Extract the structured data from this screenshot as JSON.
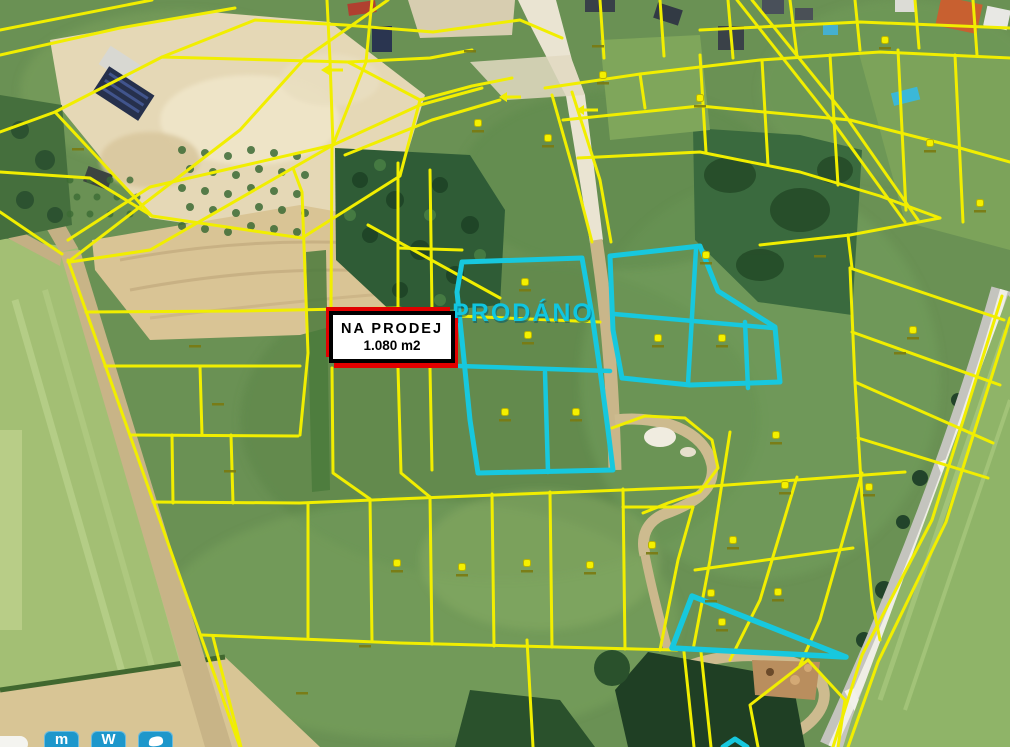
{
  "map": {
    "kind": "aerial-cadastral-map",
    "colors": {
      "cadastral_line": "#f1ee00",
      "highlight_parcel": "#17c8de",
      "marker_dot": "#f4f000",
      "marker_label": "#7a7a10",
      "railway": "#c4c4be",
      "watermark_button": "#1d97cb",
      "sale_accent": "#e10000"
    },
    "sale_label": {
      "line1": "NA   PRODEJ",
      "line2": "1.080 m2"
    },
    "sold_label": {
      "text": "PRODÁNO"
    },
    "cadastral_lines": [
      [
        [
          0,
          30
        ],
        [
          152,
          0
        ]
      ],
      [
        [
          0,
          55
        ],
        [
          120,
          28
        ],
        [
          235,
          8
        ]
      ],
      [
        [
          55,
          112
        ],
        [
          162,
          57
        ],
        [
          348,
          62
        ],
        [
          420,
          100
        ],
        [
          400,
          176
        ],
        [
          302,
          238
        ],
        [
          152,
          216
        ],
        [
          55,
          112
        ]
      ],
      [
        [
          162,
          57
        ],
        [
          255,
          20
        ],
        [
          345,
          25
        ],
        [
          433,
          32
        ],
        [
          520,
          20
        ],
        [
          562,
          38
        ]
      ],
      [
        [
          348,
          62
        ],
        [
          430,
          58
        ],
        [
          472,
          50
        ]
      ],
      [
        [
          420,
          100
        ],
        [
          472,
          86
        ],
        [
          512,
          78
        ]
      ],
      [
        [
          0,
          132
        ],
        [
          55,
          112
        ]
      ],
      [
        [
          0,
          172
        ],
        [
          90,
          178
        ],
        [
          152,
          216
        ]
      ],
      [
        [
          0,
          212
        ],
        [
          62,
          254
        ]
      ],
      [
        [
          68,
          260
        ],
        [
          240,
          747
        ]
      ],
      [
        [
          68,
          262
        ],
        [
          240,
          130
        ],
        [
          305,
          58
        ],
        [
          388,
          0
        ]
      ],
      [
        [
          333,
          145
        ],
        [
          150,
          187
        ],
        [
          68,
          240
        ]
      ],
      [
        [
          333,
          145
        ],
        [
          150,
          250
        ],
        [
          70,
          262
        ]
      ],
      [
        [
          86,
          312
        ],
        [
          240,
          311
        ],
        [
          398,
          308
        ],
        [
          458,
          316
        ],
        [
          600,
          322
        ]
      ],
      [
        [
          105,
          366
        ],
        [
          300,
          366
        ]
      ],
      [
        [
          130,
          435
        ],
        [
          298,
          436
        ]
      ],
      [
        [
          153,
          502
        ],
        [
          300,
          503
        ],
        [
          470,
          496
        ],
        [
          700,
          487
        ],
        [
          905,
          472
        ]
      ],
      [
        [
          202,
          635
        ],
        [
          400,
          643
        ],
        [
          677,
          650
        ]
      ],
      [
        [
          200,
          366
        ],
        [
          202,
          435
        ]
      ],
      [
        [
          172,
          435
        ],
        [
          173,
          503
        ]
      ],
      [
        [
          231,
          435
        ],
        [
          233,
          503
        ]
      ],
      [
        [
          213,
          637
        ],
        [
          241,
          747
        ]
      ],
      [
        [
          527,
          640
        ],
        [
          533,
          747
        ]
      ],
      [
        [
          293,
          168
        ],
        [
          302,
          192
        ],
        [
          308,
          353
        ],
        [
          300,
          435
        ]
      ],
      [
        [
          332,
          145
        ],
        [
          331,
          307
        ]
      ],
      [
        [
          332,
          368
        ],
        [
          333,
          473
        ],
        [
          370,
          499
        ]
      ],
      [
        [
          370,
          499
        ],
        [
          372,
          641
        ]
      ],
      [
        [
          308,
          503
        ],
        [
          308,
          637
        ]
      ],
      [
        [
          398,
          163
        ],
        [
          398,
          307
        ]
      ],
      [
        [
          398,
          368
        ],
        [
          401,
          473
        ],
        [
          430,
          497
        ]
      ],
      [
        [
          430,
          497
        ],
        [
          432,
          644
        ]
      ],
      [
        [
          492,
          494
        ],
        [
          494,
          646
        ]
      ],
      [
        [
          550,
          492
        ],
        [
          552,
          647
        ]
      ],
      [
        [
          623,
          489
        ],
        [
          625,
          649
        ]
      ],
      [
        [
          430,
          170
        ],
        [
          432,
          310
        ]
      ],
      [
        [
          430,
          368
        ],
        [
          432,
          470
        ]
      ],
      [
        [
          398,
          248
        ],
        [
          462,
          250
        ]
      ],
      [
        [
          333,
          145
        ],
        [
          420,
          105
        ],
        [
          482,
          88
        ]
      ],
      [
        [
          345,
          155
        ],
        [
          432,
          120
        ],
        [
          500,
          100
        ]
      ],
      [
        [
          368,
          225
        ],
        [
          500,
          298
        ]
      ],
      [
        [
          333,
          145
        ],
        [
          330,
          60
        ],
        [
          327,
          0
        ]
      ],
      [
        [
          333,
          145
        ],
        [
          366,
          62
        ],
        [
          372,
          0
        ]
      ],
      [
        [
          552,
          95
        ],
        [
          576,
          180
        ],
        [
          592,
          242
        ]
      ],
      [
        [
          572,
          92
        ],
        [
          600,
          180
        ],
        [
          611,
          242
        ]
      ],
      [
        [
          545,
          88
        ],
        [
          640,
          74
        ],
        [
          760,
          60
        ],
        [
          880,
          52
        ],
        [
          1010,
          58
        ]
      ],
      [
        [
          563,
          120
        ],
        [
          700,
          106
        ],
        [
          850,
          120
        ],
        [
          960,
          148
        ],
        [
          1010,
          162
        ]
      ],
      [
        [
          578,
          158
        ],
        [
          700,
          152
        ],
        [
          800,
          172
        ],
        [
          880,
          196
        ],
        [
          940,
          218
        ]
      ],
      [
        [
          600,
          0
        ],
        [
          604,
          58
        ]
      ],
      [
        [
          660,
          0
        ],
        [
          664,
          56
        ]
      ],
      [
        [
          728,
          0
        ],
        [
          733,
          58
        ]
      ],
      [
        [
          790,
          0
        ],
        [
          797,
          56
        ]
      ],
      [
        [
          855,
          0
        ],
        [
          860,
          50
        ]
      ],
      [
        [
          915,
          0
        ],
        [
          919,
          48
        ]
      ],
      [
        [
          973,
          0
        ],
        [
          977,
          55
        ]
      ],
      [
        [
          640,
          74
        ],
        [
          645,
          108
        ]
      ],
      [
        [
          700,
          55
        ],
        [
          706,
          152
        ]
      ],
      [
        [
          762,
          60
        ],
        [
          768,
          165
        ]
      ],
      [
        [
          830,
          55
        ],
        [
          838,
          185
        ]
      ],
      [
        [
          898,
          50
        ],
        [
          906,
          210
        ]
      ],
      [
        [
          955,
          55
        ],
        [
          963,
          222
        ]
      ],
      [
        [
          700,
          30
        ],
        [
          860,
          22
        ],
        [
          1010,
          28
        ]
      ],
      [
        [
          737,
          0
        ],
        [
          830,
          118
        ],
        [
          905,
          222
        ]
      ],
      [
        [
          752,
          0
        ],
        [
          845,
          115
        ],
        [
          918,
          220
        ]
      ],
      [
        [
          760,
          245
        ],
        [
          850,
          235
        ],
        [
          940,
          218
        ]
      ],
      [
        [
          848,
          235
        ],
        [
          852,
          268
        ]
      ],
      [
        [
          850,
          268
        ],
        [
          1004,
          320
        ]
      ],
      [
        [
          852,
          332
        ],
        [
          1000,
          385
        ]
      ],
      [
        [
          855,
          382
        ],
        [
          993,
          443
        ]
      ],
      [
        [
          858,
          438
        ],
        [
          988,
          478
        ]
      ],
      [
        [
          850,
          268
        ],
        [
          855,
          382
        ],
        [
          862,
          498
        ],
        [
          872,
          600
        ],
        [
          880,
          640
        ]
      ],
      [
        [
          1002,
          296
        ],
        [
          932,
          520
        ],
        [
          862,
          655
        ],
        [
          833,
          747
        ]
      ],
      [
        [
          1010,
          318
        ],
        [
          946,
          522
        ],
        [
          878,
          662
        ],
        [
          848,
          747
        ]
      ],
      [
        [
          730,
          432
        ],
        [
          710,
          560
        ],
        [
          693,
          650
        ]
      ],
      [
        [
          797,
          477
        ],
        [
          760,
          600
        ],
        [
          730,
          660
        ]
      ],
      [
        [
          862,
          473
        ],
        [
          820,
          620
        ],
        [
          800,
          665
        ]
      ],
      [
        [
          695,
          570
        ],
        [
          780,
          558
        ],
        [
          853,
          548
        ]
      ],
      [
        [
          684,
          652
        ],
        [
          694,
          747
        ]
      ],
      [
        [
          701,
          652
        ],
        [
          711,
          747
        ]
      ],
      [
        [
          808,
          660
        ],
        [
          750,
          705
        ],
        [
          758,
          747
        ]
      ],
      [
        [
          808,
          660
        ],
        [
          845,
          700
        ],
        [
          838,
          747
        ]
      ],
      [
        [
          623,
          507
        ],
        [
          693,
          507
        ]
      ],
      [
        [
          693,
          507
        ],
        [
          678,
          560
        ],
        [
          660,
          650
        ]
      ],
      [
        [
          612,
          428
        ],
        [
          645,
          416
        ],
        [
          685,
          418
        ],
        [
          712,
          440
        ],
        [
          718,
          468
        ],
        [
          700,
          492
        ],
        [
          668,
          503
        ],
        [
          643,
          513
        ]
      ]
    ],
    "highlight_parcels": {
      "left_group_outline": [
        [
          462,
          262
        ],
        [
          582,
          258
        ],
        [
          592,
          315
        ],
        [
          600,
          370
        ],
        [
          608,
          430
        ],
        [
          613,
          470
        ],
        [
          478,
          473
        ],
        [
          470,
          420
        ],
        [
          462,
          340
        ],
        [
          457,
          292
        ]
      ],
      "left_group_dividers": [
        [
          [
            459,
            366
          ],
          [
            610,
            371
          ]
        ],
        [
          [
            545,
            372
          ],
          [
            548,
            472
          ]
        ]
      ],
      "right_group_outline": [
        [
          610,
          256
        ],
        [
          700,
          246
        ],
        [
          718,
          291
        ],
        [
          775,
          327
        ],
        [
          780,
          382
        ],
        [
          690,
          385
        ],
        [
          622,
          378
        ],
        [
          613,
          330
        ]
      ],
      "right_group_dividers": [
        [
          [
            614,
            314
          ],
          [
            773,
            328
          ]
        ],
        [
          [
            696,
            249
          ],
          [
            688,
            384
          ]
        ],
        [
          [
            745,
            322
          ],
          [
            748,
            388
          ]
        ]
      ],
      "triangle_outline": [
        [
          692,
          596
        ],
        [
          672,
          648
        ],
        [
          846,
          657
        ]
      ],
      "bottom_notch": [
        [
          723,
          747
        ],
        [
          735,
          739
        ],
        [
          747,
          747
        ]
      ]
    },
    "parcel_markers": [
      [
        478,
        123
      ],
      [
        548,
        138
      ],
      [
        603,
        75
      ],
      [
        700,
        98
      ],
      [
        885,
        40
      ],
      [
        930,
        143
      ],
      [
        980,
        203
      ],
      [
        525,
        282
      ],
      [
        528,
        335
      ],
      [
        505,
        412
      ],
      [
        576,
        412
      ],
      [
        658,
        338
      ],
      [
        722,
        338
      ],
      [
        706,
        255
      ],
      [
        776,
        435
      ],
      [
        785,
        485
      ],
      [
        733,
        540
      ],
      [
        711,
        593
      ],
      [
        652,
        545
      ],
      [
        527,
        563
      ],
      [
        590,
        565
      ],
      [
        462,
        567
      ],
      [
        397,
        563
      ],
      [
        722,
        622
      ],
      [
        778,
        592
      ],
      [
        869,
        487
      ],
      [
        913,
        330
      ]
    ],
    "extra_parcel_labels": [
      [
        78,
        148
      ],
      [
        470,
        50
      ],
      [
        195,
        345
      ],
      [
        218,
        403
      ],
      [
        230,
        470
      ],
      [
        302,
        692
      ],
      [
        365,
        645
      ],
      [
        598,
        45
      ],
      [
        820,
        255
      ],
      [
        900,
        352
      ]
    ],
    "direction_arrows": [
      [
        335,
        70
      ],
      [
        513,
        97
      ],
      [
        590,
        110
      ]
    ],
    "watermark": {
      "buttons": [
        {
          "name": "mapy-logo-icon",
          "glyph": "m"
        },
        {
          "name": "windy-logo-icon",
          "glyph": "W"
        },
        {
          "name": "hand-logo-icon",
          "glyph": ""
        }
      ]
    }
  }
}
